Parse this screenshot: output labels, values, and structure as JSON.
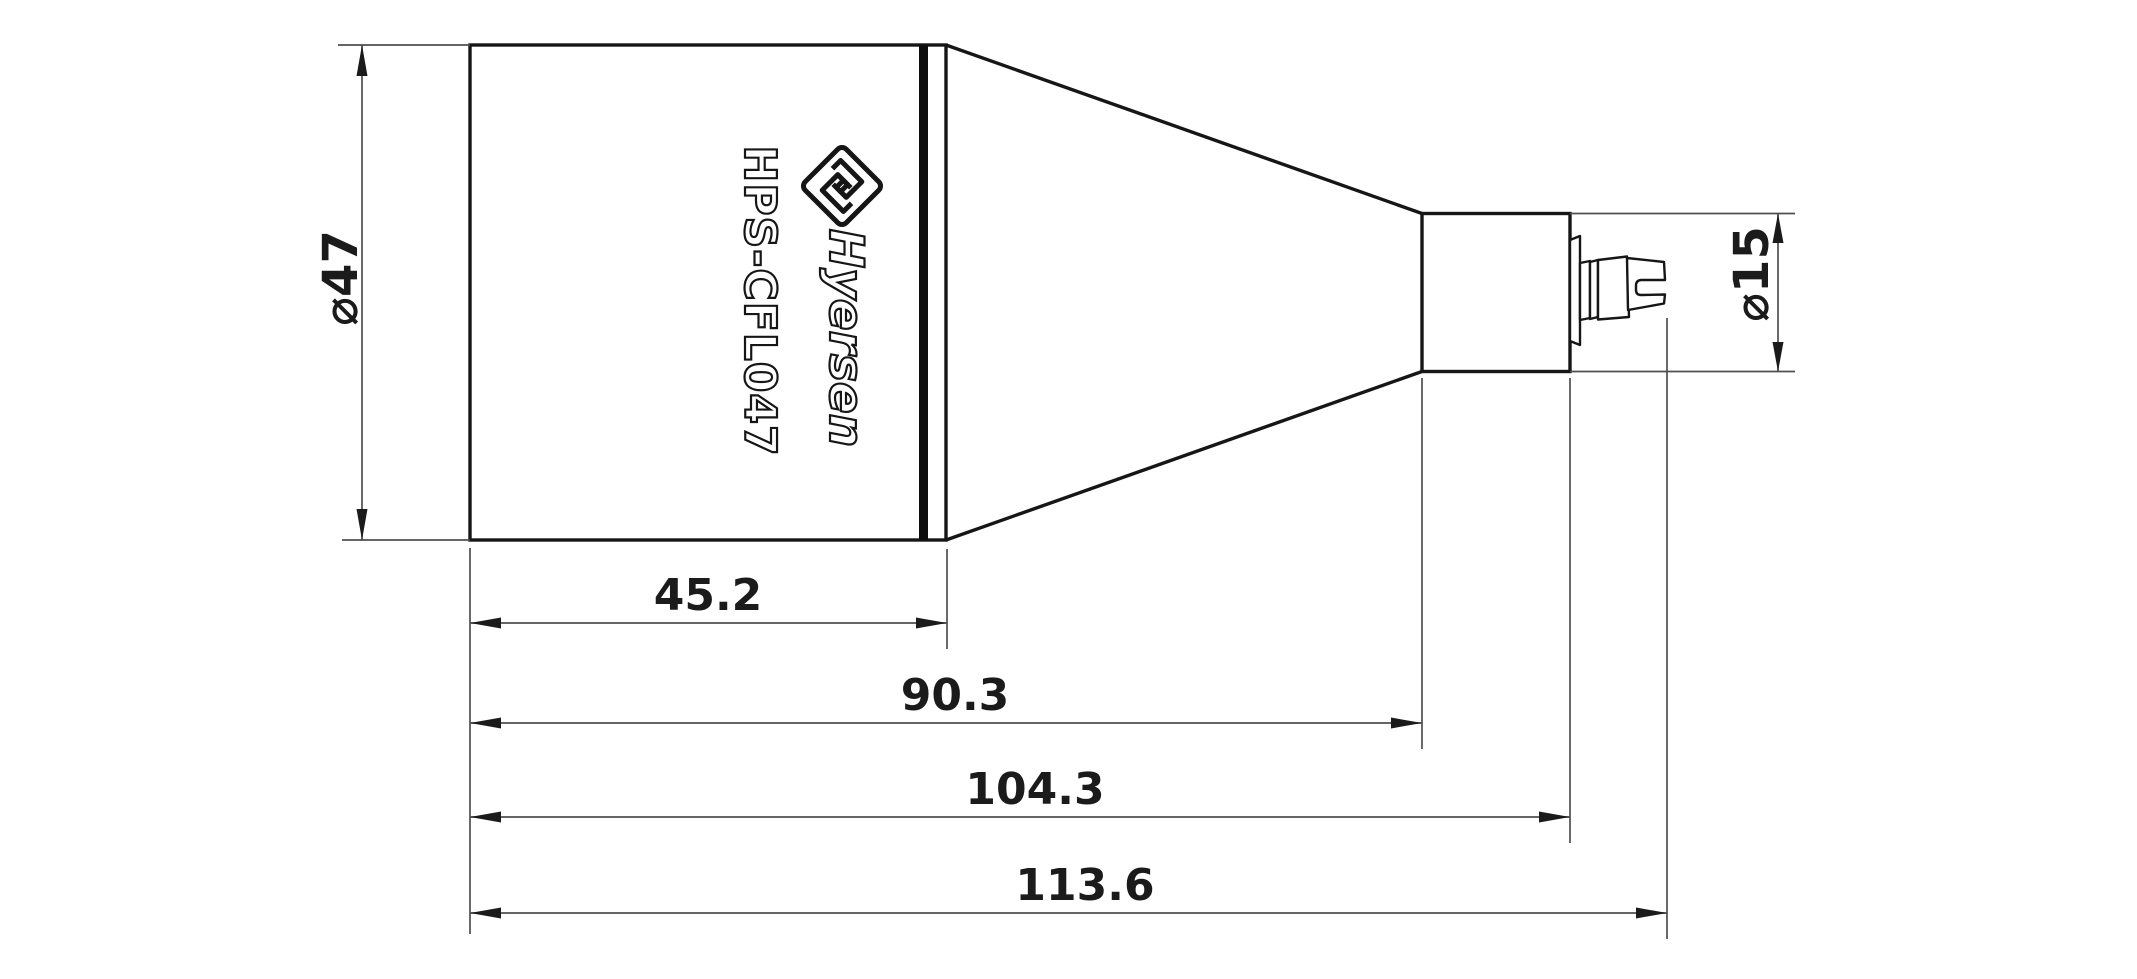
{
  "product": {
    "model": "HPS-CFL047",
    "brand": "Hyersen"
  },
  "dimensions": {
    "body_diameter": "⌀47",
    "neck_diameter": "⌀15",
    "front_section_length": "45.2",
    "horn_section_length": "90.3",
    "connector_base_length": "104.3",
    "overall_length": "113.6"
  },
  "icons": {
    "logo": "hyersen-diamond-maze-logo"
  },
  "colors": {
    "outline": "#161616",
    "dimension_lines": "#4f4f4f",
    "text": "#1b1b1b",
    "background": "#ffffff"
  }
}
